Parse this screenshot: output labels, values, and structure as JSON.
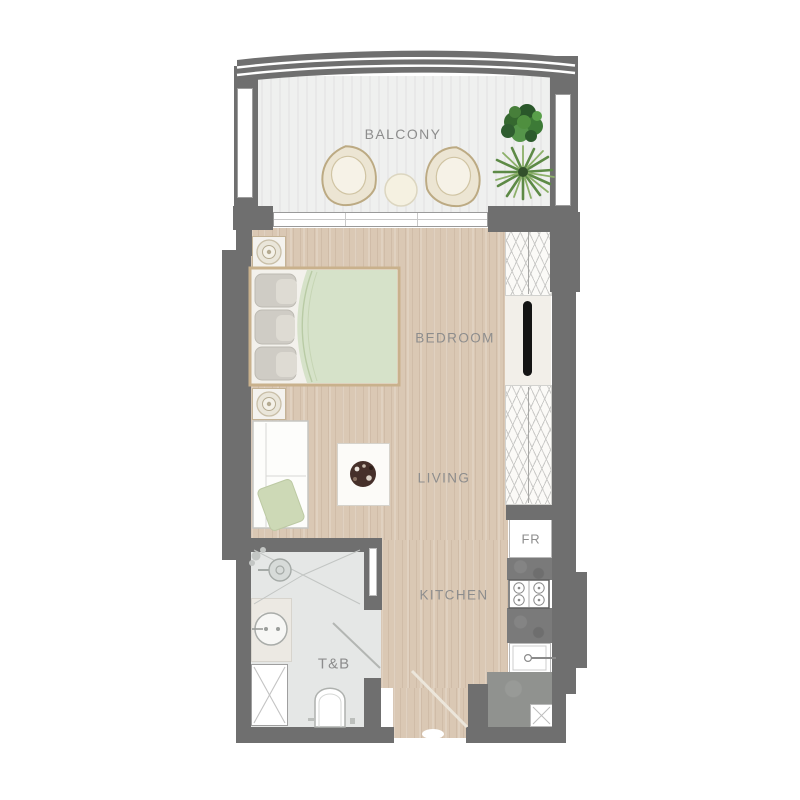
{
  "plan": {
    "title": "studio-unit-floor-plan",
    "rooms": {
      "balcony": {
        "label": "BALCONY"
      },
      "bedroom": {
        "label": "BEDROOM"
      },
      "living": {
        "label": "LIVING"
      },
      "kitchen": {
        "label": "KITCHEN"
      },
      "toilet_bath": {
        "label": "T&B"
      },
      "fridge": {
        "label": "FR"
      }
    },
    "fixtures": [
      "bed",
      "nightstand-lamp-north",
      "nightstand-lamp-south",
      "wardrobe-hangers-upper",
      "tv-panel",
      "wardrobe-hangers-lower",
      "sofa",
      "sofa-pillow",
      "coffee-table",
      "balcony-chair-left",
      "balcony-chair-right",
      "balcony-round-table",
      "potted-plant-bush",
      "potted-plant-palm",
      "refrigerator",
      "cooktop-4-burner",
      "kitchen-sink",
      "bathroom-vanity-sink",
      "shower-head",
      "toilet",
      "service-shaft",
      "utility-box",
      "entry-door-swing",
      "bath-door-swing",
      "sliding-balcony-door"
    ],
    "colors": {
      "wall": "#6f6f6f",
      "wood_floor": "#dac8b4",
      "balcony_floor": "#eff0ef",
      "bath_floor": "#e5e7e6",
      "label_text": "#8d8d8d",
      "bed_blanket": "#d6e2c9",
      "sofa_pillow": "#cdd9b6",
      "plant_dark_green": "#2f5d30",
      "plant_light_green": "#7fa65c",
      "counter": "#7a7a7a",
      "utility_gray": "#90928f",
      "bed_frame": "#c9b18c"
    }
  }
}
